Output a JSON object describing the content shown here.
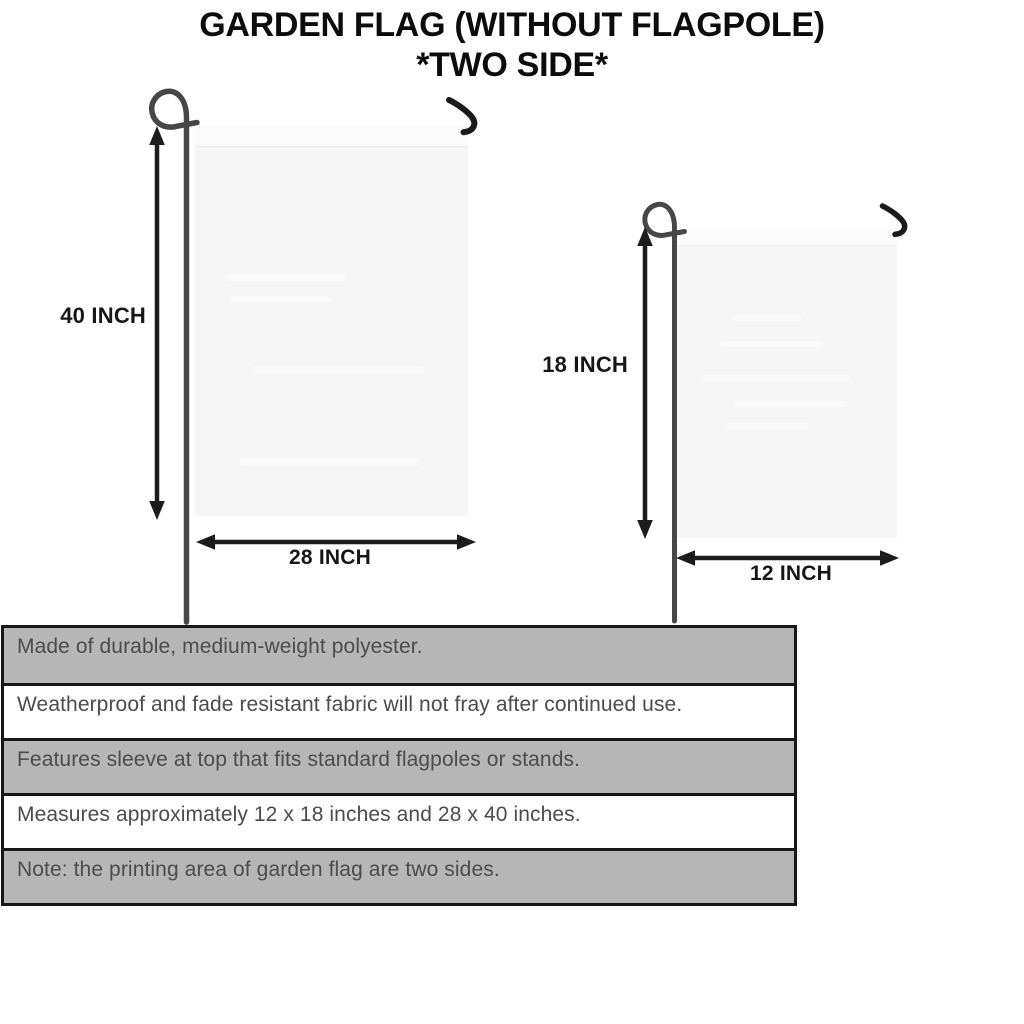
{
  "title": {
    "line1": "GARDEN FLAG (WITHOUT FLAGPOLE)",
    "line2": "*TWO SIDE*"
  },
  "flags": {
    "large": {
      "height_label": "40 INCH",
      "width_label": "28 INCH"
    },
    "small": {
      "height_label": "18 INCH",
      "width_label": "12 INCH"
    }
  },
  "features": [
    "Made of durable, medium-weight polyester.",
    "Weatherproof and fade resistant fabric will not fray after continued use.",
    "Features sleeve at top that fits standard flagpoles or stands.",
    "Measures approximately 12 x 18 inches and 28 x 40 inches.",
    "Note: the printing area of garden flag are two sides."
  ],
  "colors": {
    "background": "#ffffff",
    "title_text": "#0c0c0c",
    "dimension_text": "#171717",
    "arrow": "#1c1c1c",
    "pole": "#474747",
    "hook": "#1a1a1a",
    "flag_fill": "#f6f6f7",
    "flag_sleeve": "#fbfbfc",
    "table_border": "#171717",
    "row_shaded_bg": "#b6b6b6",
    "row_plain_bg": "#ffffff",
    "row_text": "#4c4c4c"
  }
}
